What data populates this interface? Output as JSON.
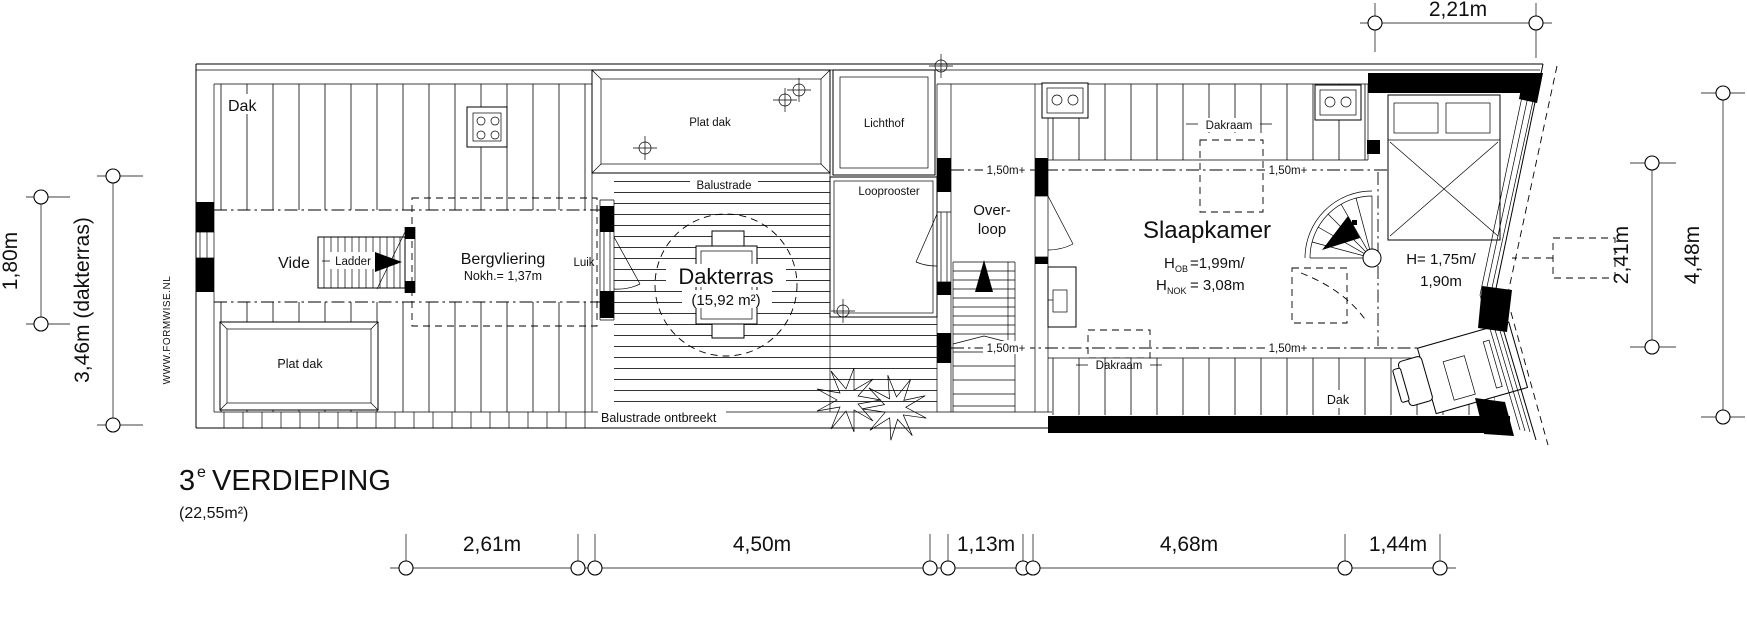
{
  "drawing": {
    "title": {
      "floor_number": "3",
      "floor_sup": "e",
      "floor_name": "VERDIEPING",
      "area": "(22,55m²)"
    },
    "watermark": "WWW.FORMWISE.NL",
    "rooms": {
      "dak_left": "Dak",
      "vide": "Vide",
      "ladder": "Ladder",
      "bergvliering": "Bergvliering",
      "bergvliering_note": "Nokh.= 1,37m",
      "plat_dak_left": "Plat dak",
      "plat_dak_top": "Plat dak",
      "lichthof": "Lichthof",
      "balustrade": "Balustrade",
      "looprooster": "Looprooster",
      "luik": "Luik",
      "dakterras": "Dakterras",
      "dakterras_area": "(15,92 m²)",
      "balustrade_note": "Balustrade ontbreekt",
      "overloop_line1": "Over-",
      "overloop_line2": "loop",
      "slaapkamer": "Slaapkamer",
      "slaapkamer_h1_prefix": "H",
      "slaapkamer_h1_sub": "OB",
      "slaapkamer_h1_value": "=1,99m/",
      "slaapkamer_h2_prefix": "H",
      "slaapkamer_h2_sub": "NOK",
      "slaapkamer_h2_value": "= 3,08m",
      "dakraam": "Dakraam",
      "dak_right": "Dak",
      "bed_height_line1": "H= 1,75m/",
      "bed_height_line2": "1,90m",
      "level_mark": "1,50m+"
    },
    "dimensions": {
      "top": "2,21m",
      "left_inner": "1,80m",
      "left_outer": "3,46m (dakterras)",
      "right_inner": "2,41m",
      "right_outer": "4,48m",
      "bottom": [
        "2,61m",
        "4,50m",
        "1,13m",
        "4,68m",
        "1,44m"
      ]
    },
    "colors": {
      "line": "#000000",
      "background": "#ffffff"
    }
  }
}
